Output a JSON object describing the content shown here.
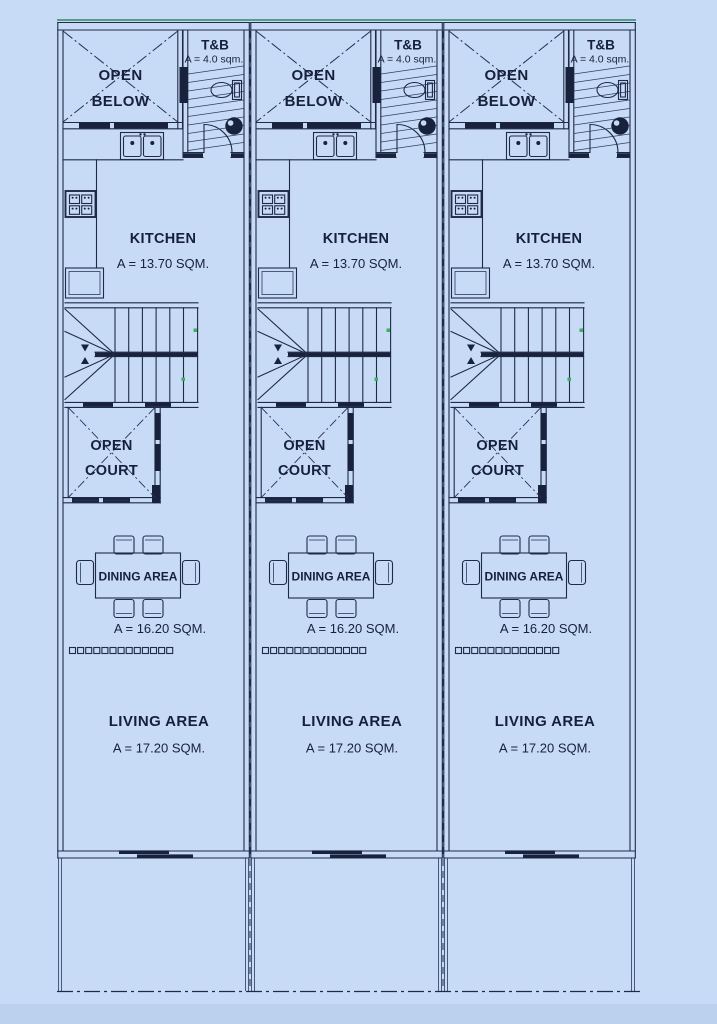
{
  "plan": {
    "type": "architectural-floor-plan",
    "units_count": 3,
    "colors": {
      "background": "#c7dbf7",
      "line": "#1f2a47",
      "dark_fill": "#18223c",
      "text": "#17203a",
      "green_line": "#2e8a66",
      "green_marker": "#3fae62",
      "bottom_band": "#b3c9e8"
    }
  },
  "units": [
    {
      "id": "unit-1",
      "labels": {
        "open_below_1": "OPEN",
        "open_below_2": "BELOW",
        "tb": "T&B",
        "tb_area": "A = 4.0 sqm.",
        "kitchen": "KITCHEN",
        "kitchen_area": "A = 13.70 SQM.",
        "court_1": "OPEN",
        "court_2": "COURT",
        "dining": "DINING AREA",
        "dining_area": "A = 16.20 SQM.",
        "living": "LIVING AREA",
        "living_area": "A = 17.20 SQM."
      }
    },
    {
      "id": "unit-2",
      "labels": {
        "open_below_1": "OPEN",
        "open_below_2": "BELOW",
        "tb": "T&B",
        "tb_area": "A = 4.0 sqm.",
        "kitchen": "KITCHEN",
        "kitchen_area": "A = 13.70 SQM.",
        "court_1": "OPEN",
        "court_2": "COURT",
        "dining": "DINING AREA",
        "dining_area": "A = 16.20 SQM.",
        "living": "LIVING AREA",
        "living_area": "A = 17.20 SQM."
      }
    },
    {
      "id": "unit-3",
      "labels": {
        "open_below_1": "OPEN",
        "open_below_2": "BELOW",
        "tb": "T&B",
        "tb_area": "A = 4.0 sqm.",
        "kitchen": "KITCHEN",
        "kitchen_area": "A = 13.70 SQM.",
        "court_1": "OPEN",
        "court_2": "COURT",
        "dining": "DINING AREA",
        "dining_area": "A = 16.20 SQM.",
        "living": "LIVING AREA",
        "living_area": "A = 17.20 SQM."
      }
    }
  ]
}
